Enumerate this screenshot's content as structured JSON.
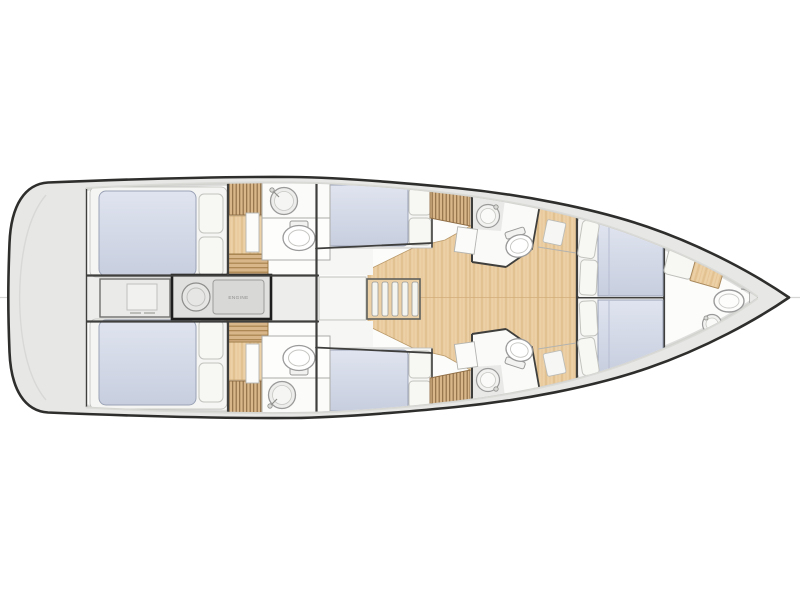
{
  "diagram": {
    "type": "sailing-yacht-interior-floor-plan-top-view",
    "orientation": {
      "bow": "right",
      "stern": "left"
    },
    "labels": {
      "engine": "ENGINE"
    },
    "colors": {
      "hull_outline": "#2e2e2c",
      "deck": "#e7e7e5",
      "deck_shade": "#d7d7d5",
      "interior": "#fcfcfb",
      "wood": "#ecd0a6",
      "wood_grain": "#d9b47c",
      "slat": "#d8b689",
      "slat_dark": "#8d6c44",
      "mattress": "#d3d8e8",
      "mattress_dark": "#c7cede",
      "pillow": "#f7f7f4",
      "wall": "#3f3f3d",
      "furniture_line": "#a3a3a0",
      "fixture_line": "#9a9a9a",
      "corridor": "#ededec",
      "engine_border": "#1e1e1e"
    },
    "compartments": [
      {
        "name": "swim-platform-stern",
        "fixtures": []
      },
      {
        "name": "aft-cabin-port",
        "fixtures": [
          "double-berth",
          "pillows"
        ]
      },
      {
        "name": "aft-cabin-starboard",
        "fixtures": [
          "double-berth",
          "pillows"
        ]
      },
      {
        "name": "engine-room",
        "fixtures": [
          "engine-block",
          "generator"
        ]
      },
      {
        "name": "stern-locker",
        "fixtures": [
          "hatch"
        ]
      },
      {
        "name": "aft-head-port",
        "fixtures": [
          "sink",
          "toilet",
          "wood-steps",
          "louvered-locker"
        ]
      },
      {
        "name": "aft-head-starboard",
        "fixtures": [
          "sink",
          "toilet",
          "wood-steps",
          "louvered-locker"
        ]
      },
      {
        "name": "mid-cabin-port",
        "fixtures": [
          "double-berth",
          "pillows"
        ]
      },
      {
        "name": "mid-cabin-starboard",
        "fixtures": [
          "double-berth",
          "pillows"
        ]
      },
      {
        "name": "salon",
        "fixtures": [
          "companionway-stairs",
          "wood-floor",
          "landing"
        ]
      },
      {
        "name": "forward-head-port",
        "fixtures": [
          "sink",
          "toilet",
          "louvered-locker",
          "door"
        ]
      },
      {
        "name": "forward-head-starboard",
        "fixtures": [
          "sink",
          "toilet",
          "louvered-locker",
          "door"
        ]
      },
      {
        "name": "forward-cabin",
        "fixtures": [
          "twin-berths",
          "pillows",
          "headboard"
        ]
      },
      {
        "name": "bow-head",
        "fixtures": [
          "toilet",
          "sink",
          "seat-cushion",
          "wood-locker"
        ]
      },
      {
        "name": "anchor-locker-bow",
        "fixtures": []
      }
    ]
  }
}
